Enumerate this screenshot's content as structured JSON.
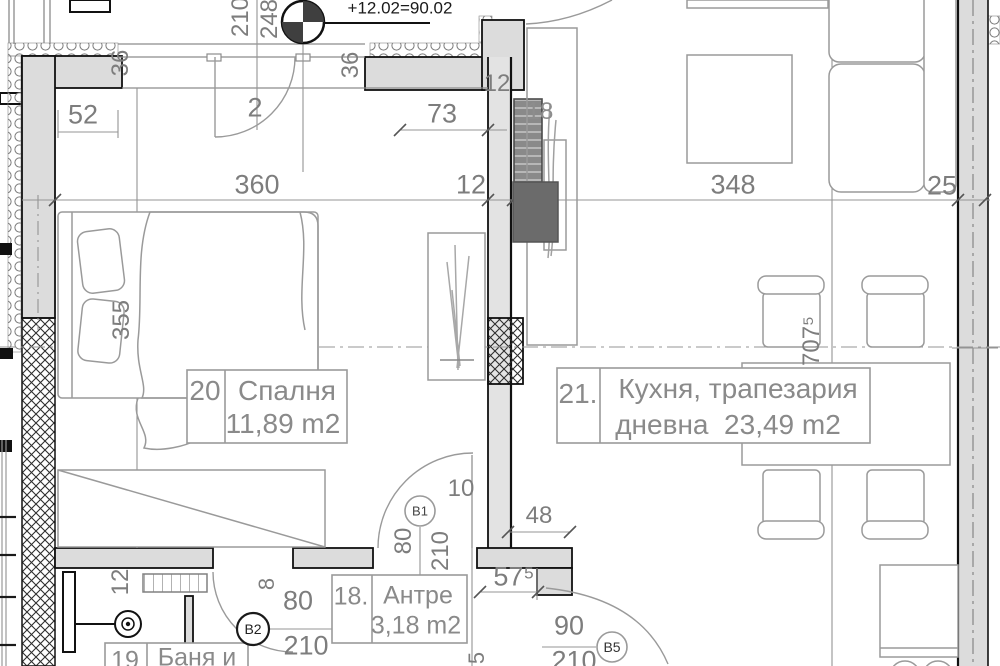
{
  "drawing": {
    "type": "apartment-floor-plan",
    "elevation_note": "+12.02=90.02",
    "rooms": [
      {
        "number": "20",
        "name": "Спалня",
        "area": "11,89 m2"
      },
      {
        "number": "21.",
        "name": "Кухня, трапезария дневна",
        "area": "23,49 m2"
      },
      {
        "number": "18.",
        "name": "Антре",
        "area": "3,18 m2"
      },
      {
        "number": "19",
        "name": "Баня и",
        "area": ""
      }
    ],
    "door_marks": [
      "В1",
      "В2",
      "В5"
    ],
    "colors": {
      "wall_fill": "#dcdcdc",
      "line_gray": "#999999",
      "text_gray": "#7d7d7d",
      "black": "#1a1a1a"
    }
  },
  "labels": [
    {
      "name": "elevation-note",
      "text": "+12.02=90.02",
      "x": 400,
      "y": 8,
      "size": 17,
      "color": "#1a1a1a"
    },
    {
      "name": "dim-210-vert",
      "text": "210",
      "x": 241,
      "y": 17,
      "rot": -90
    },
    {
      "name": "dim-248-vert",
      "text": "248",
      "x": 270,
      "y": 19,
      "rot": -90
    },
    {
      "name": "door-number-2",
      "text": "2",
      "x": 255,
      "y": 108,
      "size": 27
    },
    {
      "name": "dim-52",
      "text": "52",
      "x": 83,
      "y": 115,
      "size": 27
    },
    {
      "name": "dim-36-corner-vert",
      "text": "36",
      "x": 121,
      "y": 63,
      "rot": -90
    },
    {
      "name": "dim-36-pier-vert",
      "text": "36",
      "x": 351,
      "y": 65,
      "rot": -90
    },
    {
      "name": "dim-73",
      "text": "73",
      "x": 442,
      "y": 114,
      "size": 27
    },
    {
      "name": "dim-12-top",
      "text": "12",
      "x": 497,
      "y": 84
    },
    {
      "name": "dim-18",
      "text": "18",
      "x": 540,
      "y": 112,
      "color": "#8d8d8d"
    },
    {
      "name": "dim-360",
      "text": "360",
      "x": 257,
      "y": 185,
      "size": 27
    },
    {
      "name": "dim-12-chain",
      "text": "12",
      "x": 471,
      "y": 185,
      "size": 27
    },
    {
      "name": "dim-348",
      "text": "348",
      "x": 733,
      "y": 185,
      "size": 27
    },
    {
      "name": "dim-25",
      "text": "25",
      "x": 942,
      "y": 186,
      "size": 27
    },
    {
      "name": "dim-355-vert",
      "text": "355",
      "x": 122,
      "y": 320,
      "rot": -90
    },
    {
      "name": "dim-7075-vert",
      "text": "707⁵",
      "x": 812,
      "y": 341,
      "rot": -90
    },
    {
      "name": "dim-10",
      "text": "10",
      "x": 461,
      "y": 489
    },
    {
      "name": "dim-80-door1-vert",
      "text": "80",
      "x": 404,
      "y": 541,
      "rot": -90
    },
    {
      "name": "dim-210-door1-vert",
      "text": "210",
      "x": 441,
      "y": 551,
      "rot": -90
    },
    {
      "name": "dim-48",
      "text": "48",
      "x": 539,
      "y": 516
    },
    {
      "name": "dim-575",
      "text": "57⁵",
      "x": 514,
      "y": 577,
      "size": 27
    },
    {
      "name": "dim-90",
      "text": "90",
      "x": 569,
      "y": 626,
      "size": 27
    },
    {
      "name": "dim-210-door5",
      "text": "210",
      "x": 574,
      "y": 661,
      "size": 27
    },
    {
      "name": "dim-80-door2",
      "text": "80",
      "x": 298,
      "y": 601,
      "size": 27
    },
    {
      "name": "dim-210-door2",
      "text": "210",
      "x": 306,
      "y": 646,
      "size": 27
    },
    {
      "name": "dim-12-hall-vert",
      "text": "12",
      "x": 121,
      "y": 582,
      "rot": -90
    },
    {
      "name": "dim-8-hall-vert",
      "text": "8",
      "x": 267,
      "y": 584,
      "rot": -90,
      "size": 22
    },
    {
      "name": "dim-5-bottom-vert",
      "text": "5",
      "x": 477,
      "y": 658,
      "rot": -90,
      "size": 22
    },
    {
      "name": "door-mark-b1",
      "text": "В1",
      "x": 420,
      "y": 511,
      "size": 13,
      "color": "#444444"
    },
    {
      "name": "door-mark-b2",
      "text": "В2",
      "x": 253,
      "y": 629,
      "size": 14,
      "color": "#222222"
    },
    {
      "name": "door-mark-b5",
      "text": "В5",
      "x": 612,
      "y": 647,
      "size": 14,
      "color": "#333333"
    },
    {
      "name": "room20-number",
      "text": "20",
      "x": 205,
      "y": 391,
      "size": 28,
      "color": "#8a8a8a"
    },
    {
      "name": "room20-name",
      "text": "Спалня",
      "x": 287,
      "y": 391,
      "size": 28,
      "color": "#8a8a8a"
    },
    {
      "name": "room20-area",
      "text": "11,89 m2",
      "x": 283,
      "y": 424,
      "size": 28,
      "color": "#8a8a8a"
    },
    {
      "name": "room21-number",
      "text": "21.",
      "x": 578,
      "y": 394,
      "size": 28,
      "color": "#8a8a8a"
    },
    {
      "name": "room21-name",
      "text": "Кухня, трапезария",
      "x": 738,
      "y": 389,
      "size": 28,
      "color": "#8a8a8a"
    },
    {
      "name": "room21-area",
      "text": "дневна  23,49 m2",
      "x": 728,
      "y": 425,
      "size": 28,
      "color": "#8a8a8a"
    },
    {
      "name": "room18-number",
      "text": "18.",
      "x": 351,
      "y": 597,
      "size": 25,
      "color": "#8a8a8a"
    },
    {
      "name": "room18-name",
      "text": "Антре",
      "x": 418,
      "y": 596,
      "size": 25,
      "color": "#8a8a8a"
    },
    {
      "name": "room18-area",
      "text": "3,18 m2",
      "x": 416,
      "y": 626,
      "size": 25,
      "color": "#8a8a8a"
    },
    {
      "name": "room19-number",
      "text": "19",
      "x": 125,
      "y": 661,
      "size": 25,
      "color": "#8a8a8a"
    },
    {
      "name": "room19-name",
      "text": "Баня и",
      "x": 197,
      "y": 658,
      "size": 25,
      "color": "#8a8a8a"
    }
  ]
}
